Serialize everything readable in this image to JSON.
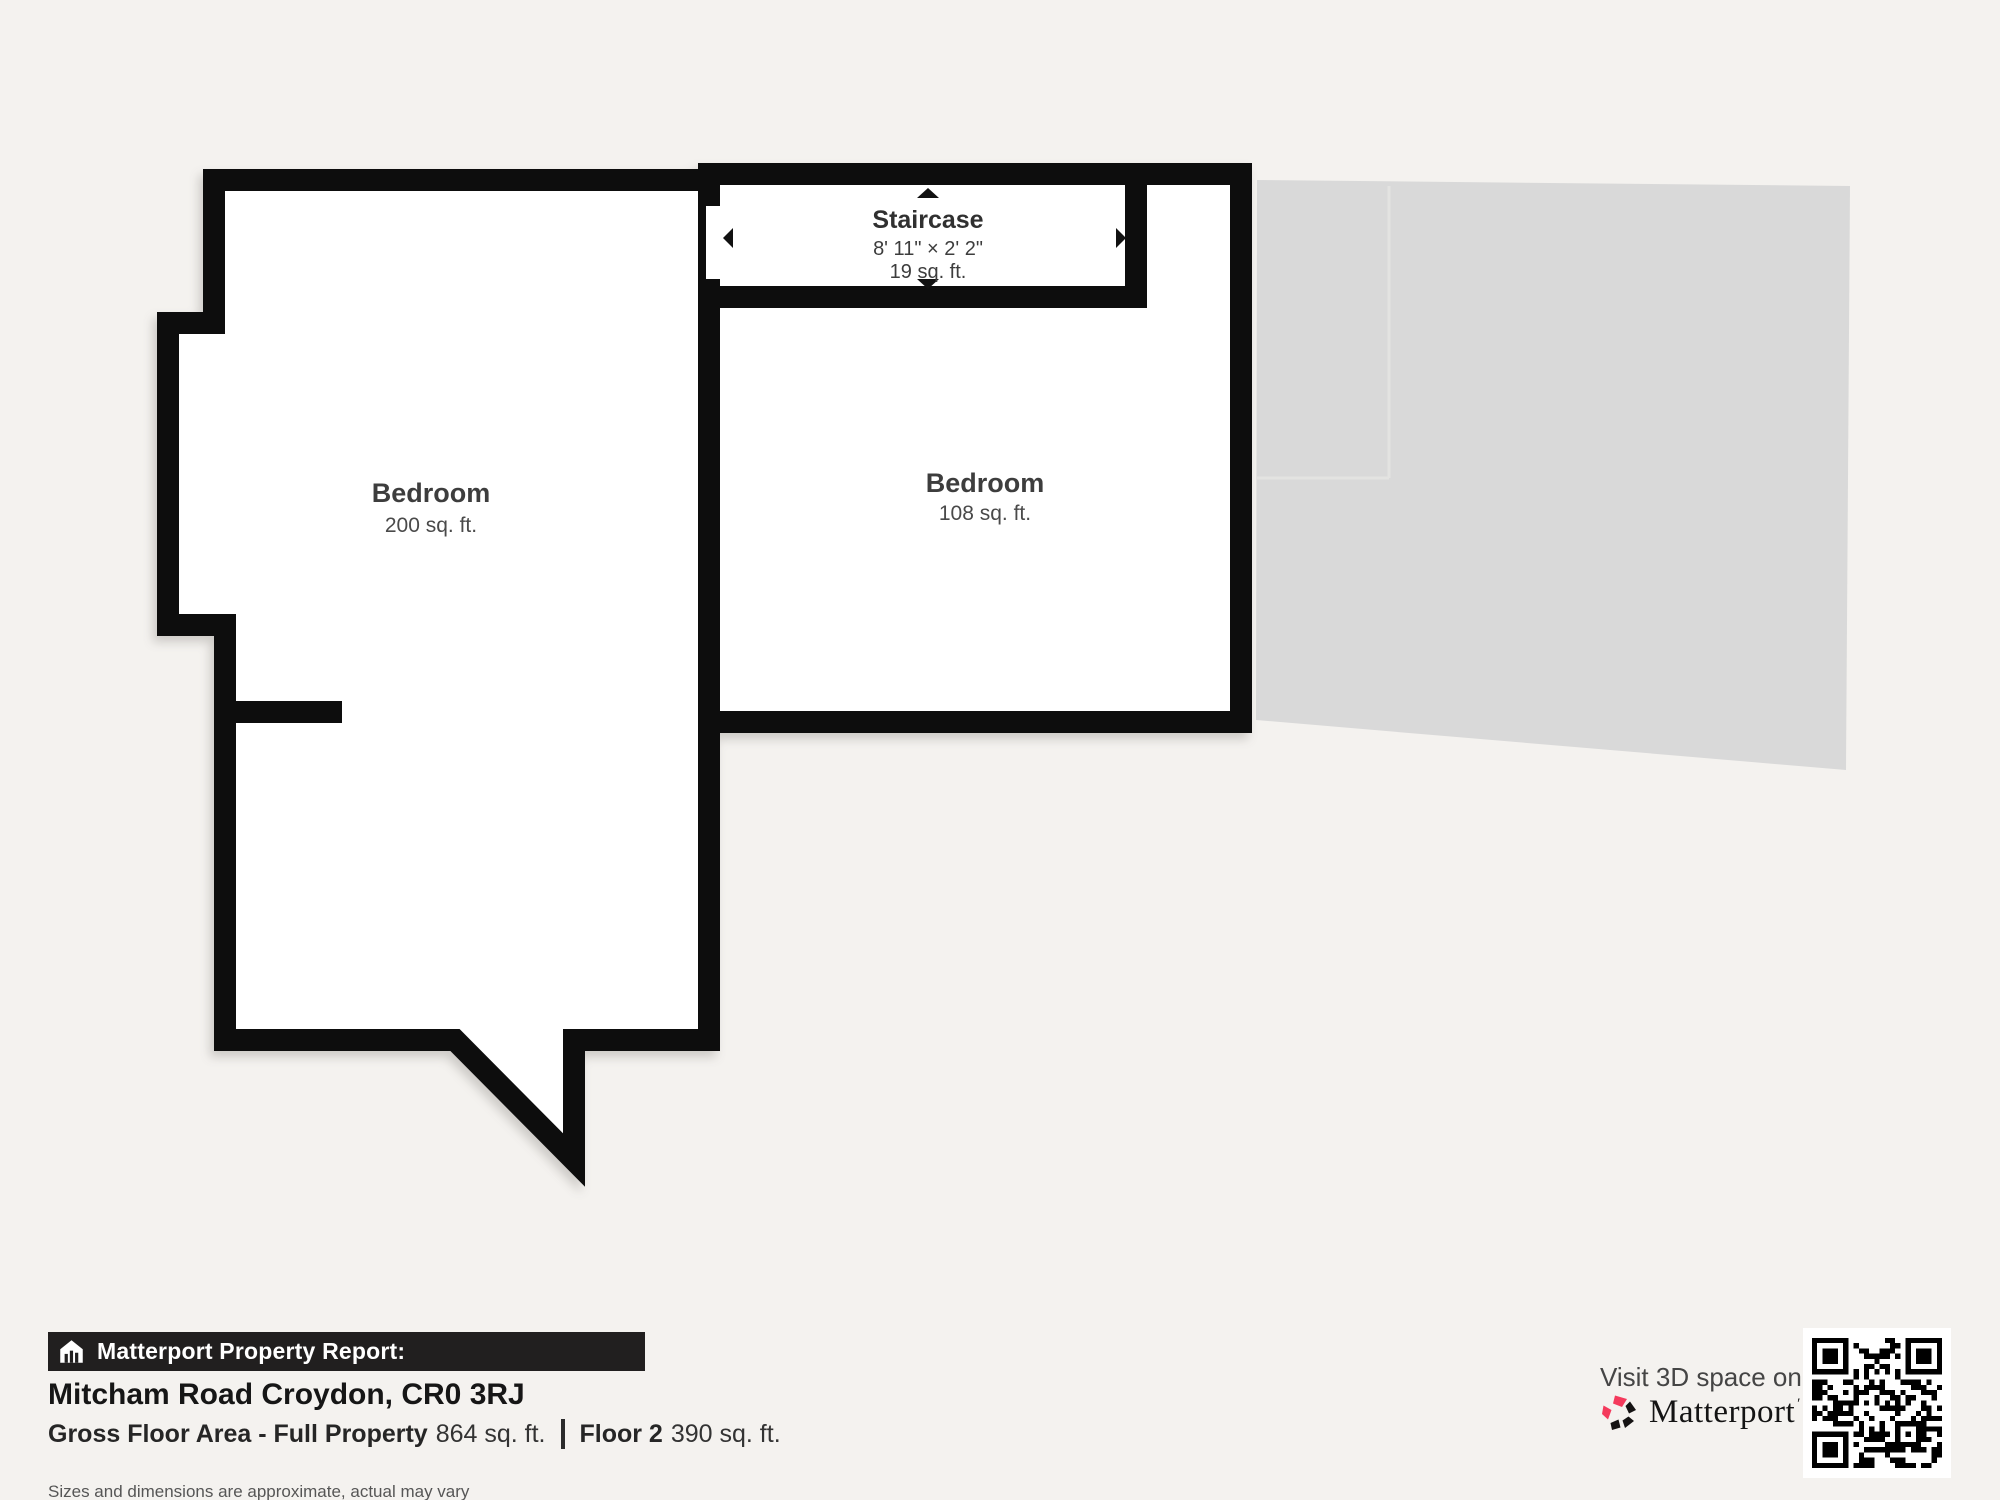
{
  "plan": {
    "rooms": [
      {
        "name": "Bedroom",
        "area": "200 sq. ft."
      },
      {
        "name": "Bedroom",
        "area": "108 sq. ft."
      }
    ],
    "staircase": {
      "name": "Staircase",
      "dimensions": "8' 11\" × 2' 2\"",
      "area": "19 sq. ft."
    },
    "colors": {
      "wall": "#0d0d0d",
      "room_fill": "#ffffff",
      "ghost_floor": "#d9d9d9",
      "background": "#f4f2ef"
    }
  },
  "report": {
    "bar_label": "Matterport Property Report:",
    "address": "Mitcham Road Croydon, CR0 3RJ",
    "gross_label": "Gross Floor Area - Full Property",
    "gross_value": "864 sq. ft.",
    "floor_label": "Floor 2",
    "floor_value": "390 sq. ft.",
    "disclaimer": "Sizes and dimensions are approximate, actual may vary"
  },
  "promo": {
    "visit_text": "Visit 3D space on",
    "brand": "Matterport",
    "brand_accent": "#f43a5c"
  }
}
